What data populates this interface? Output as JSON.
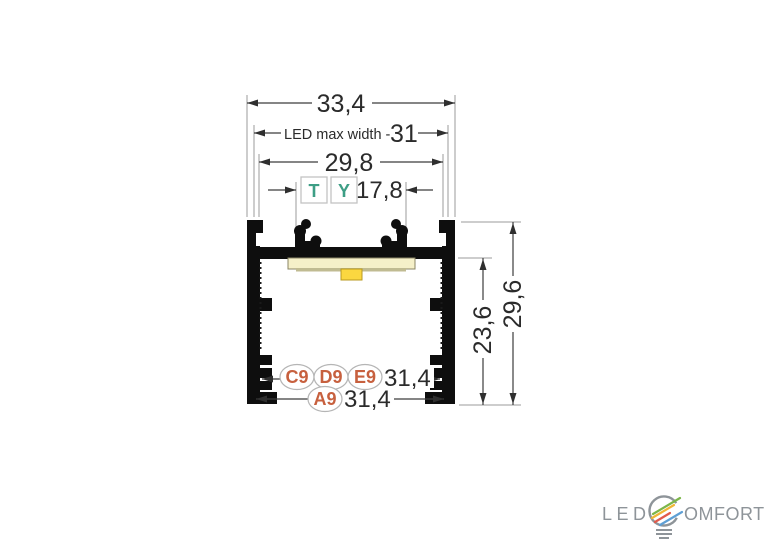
{
  "drawing_title": "LED aluminium profile cross-section",
  "colors": {
    "profile": "#0e0e0e",
    "dim_line": "#3c3c3c",
    "ext_line": "#9b9b9b",
    "text": "#2b2b2b",
    "marker_teal": "#3d9e85",
    "badge_text": "#c7603e",
    "pcb": "#f5f0c9",
    "pcb_border": "#8a8565",
    "pcb_holder": "#c0bb92",
    "led": "#fbd740",
    "led_border": "#b89a20",
    "logo_gray": "#8e9499",
    "logo_green": "#7cb649",
    "logo_yellow": "#f0b636",
    "logo_red": "#e15a4b",
    "logo_blue": "#5e9fd4"
  },
  "dimensions": {
    "outer_width": "33,4",
    "led_max_width_label": "LED max width -",
    "led_max_width_value": "31",
    "opening_width": "29,8",
    "clip_spacing": "17,8",
    "inner_height": "23,6",
    "outer_height": "29,6",
    "groove_width_top": "31,4",
    "groove_width_bottom": "31,4"
  },
  "markers": {
    "t": "T",
    "y": "Y"
  },
  "badges": {
    "c9": "C9",
    "d9": "D9",
    "e9": "E9",
    "a9": "A9"
  },
  "logo": {
    "prefix": "LED",
    "suffix": "OMFORT"
  }
}
